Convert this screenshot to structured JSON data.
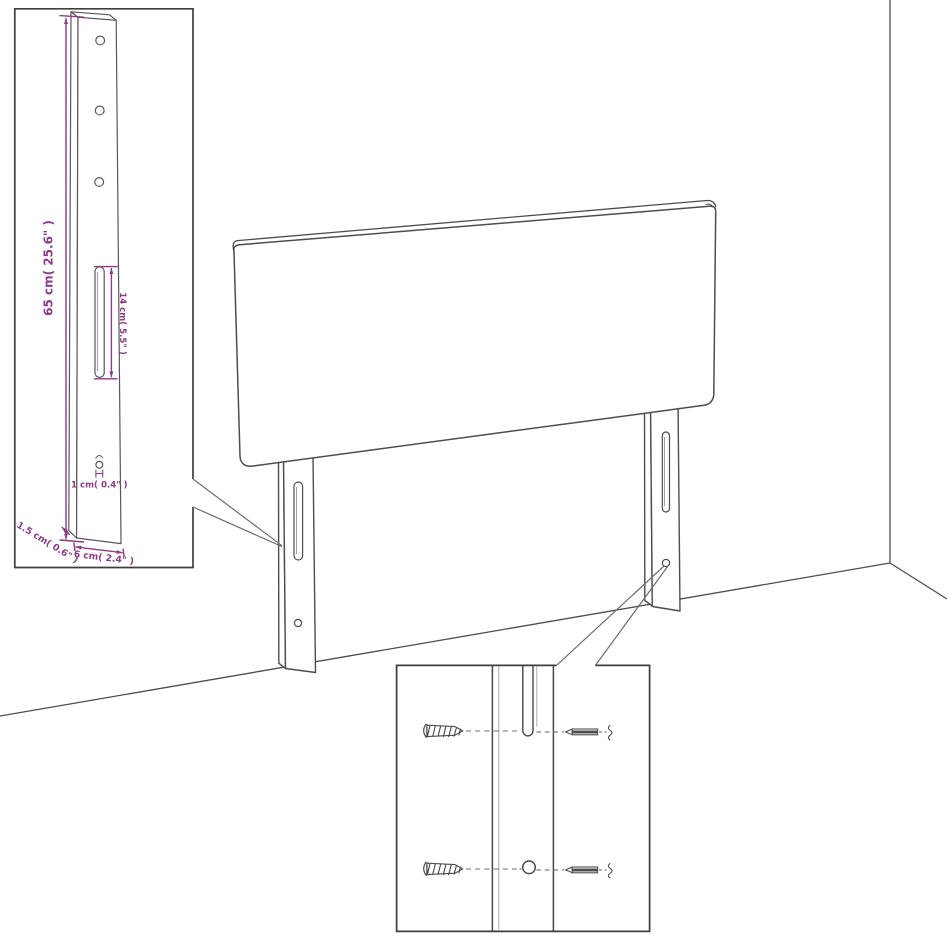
{
  "colors": {
    "background": "#ffffff",
    "line": "#4d4d4d",
    "inset_border": "#3f3f3f",
    "dimension": "#8a3c85"
  },
  "inset_leg_detail": {
    "labels": {
      "height": "65 cm( 25.6\" )",
      "slot_length": "14 cm( 5.5\" )",
      "hole_diameter": "1 cm( 0.4\" )",
      "side_thickness": "1.5 cm( 0.6\" )",
      "front_width": "6 cm( 2.4\" )"
    }
  }
}
